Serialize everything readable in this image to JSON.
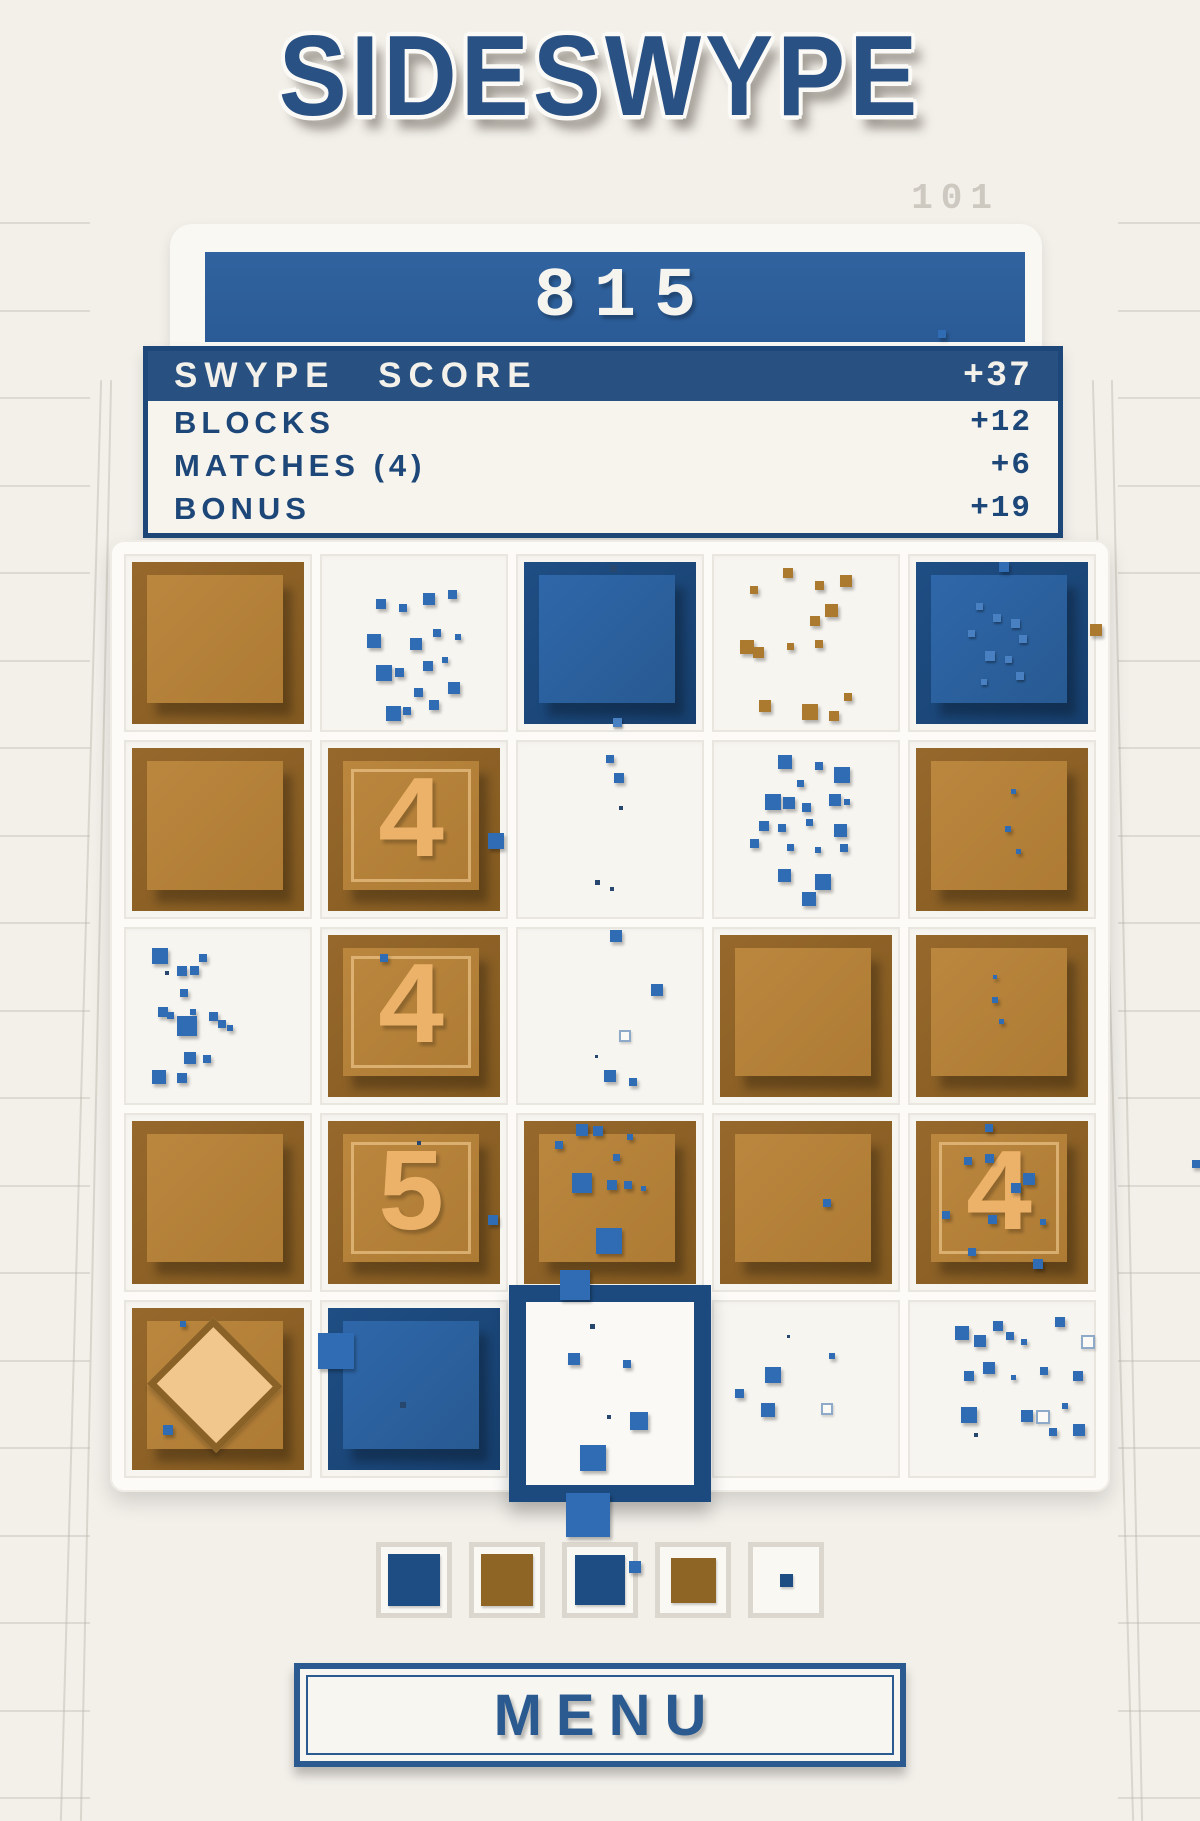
{
  "title": "SIDESWYPE",
  "hud": {
    "level": "101",
    "score": "815"
  },
  "score_panel": {
    "header_label": "SWYPE SCORE",
    "header_value": "+37",
    "rows": [
      {
        "label": "BLOCKS",
        "value": "+12"
      },
      {
        "label": "MATCHES (4)",
        "value": "+6"
      },
      {
        "label": "BONUS",
        "value": "+19"
      }
    ]
  },
  "menu_label": "MENU",
  "colors": {
    "accent_blue": "#2a5183",
    "bar_blue": "#2e5f9e",
    "block_blue": "#1d4d82",
    "block_brown": "#97682c",
    "numeral_tan": "#edb269",
    "background": "#f3f0ea"
  },
  "grid": {
    "rows": 5,
    "cols": 5,
    "cells": [
      {
        "type": "brown"
      },
      {
        "type": "empty",
        "dots": [
          [
            30,
            25,
            10,
            "b"
          ],
          [
            42,
            28,
            8,
            "b"
          ],
          [
            55,
            22,
            12,
            "b"
          ],
          [
            68,
            20,
            9,
            "b"
          ],
          [
            25,
            45,
            14,
            "b"
          ],
          [
            48,
            47,
            12,
            "b"
          ],
          [
            60,
            42,
            8,
            "b"
          ],
          [
            72,
            45,
            6,
            "b"
          ],
          [
            30,
            62,
            16,
            "b"
          ],
          [
            40,
            64,
            9,
            "b"
          ],
          [
            55,
            60,
            10,
            "b"
          ],
          [
            65,
            58,
            6,
            "b"
          ],
          [
            50,
            75,
            9,
            "b"
          ],
          [
            68,
            72,
            12,
            "b"
          ],
          [
            35,
            85,
            15,
            "b"
          ],
          [
            44,
            86,
            8,
            "b"
          ],
          [
            58,
            82,
            10,
            "b"
          ]
        ]
      },
      {
        "type": "blue",
        "dots": [
          [
            50,
            2,
            7,
            "d"
          ],
          [
            52,
            96,
            9,
            "l"
          ]
        ]
      },
      {
        "type": "empty",
        "dots": [
          [
            38,
            8,
            10,
            "n"
          ],
          [
            20,
            18,
            8,
            "n"
          ],
          [
            55,
            15,
            9,
            "n"
          ],
          [
            68,
            12,
            12,
            "n"
          ],
          [
            60,
            28,
            13,
            "n"
          ],
          [
            52,
            35,
            10,
            "n"
          ],
          [
            15,
            48,
            14,
            "n"
          ],
          [
            22,
            52,
            11,
            "n"
          ],
          [
            40,
            50,
            7,
            "n"
          ],
          [
            55,
            48,
            8,
            "n"
          ],
          [
            25,
            82,
            12,
            "n"
          ],
          [
            48,
            84,
            16,
            "n"
          ],
          [
            62,
            88,
            10,
            "n"
          ],
          [
            70,
            78,
            8,
            "n"
          ]
        ]
      },
      {
        "type": "blue",
        "dots": [
          [
            35,
            25,
            7,
            "l"
          ],
          [
            45,
            32,
            8,
            "l"
          ],
          [
            55,
            35,
            9,
            "l"
          ],
          [
            30,
            42,
            7,
            "l"
          ],
          [
            60,
            45,
            8,
            "l"
          ],
          [
            40,
            55,
            10,
            "l"
          ],
          [
            52,
            58,
            7,
            "l"
          ],
          [
            58,
            68,
            8,
            "l"
          ],
          [
            38,
            72,
            6,
            "l"
          ],
          [
            48,
            0,
            10,
            "b"
          ]
        ]
      },
      {
        "type": "brown"
      },
      {
        "type": "brown",
        "num": "4",
        "dots": [
          [
            93,
            52,
            16,
            "b"
          ]
        ]
      },
      {
        "type": "empty",
        "dots": [
          [
            48,
            8,
            8,
            "b"
          ],
          [
            52,
            18,
            10,
            "b"
          ],
          [
            55,
            37,
            4,
            "d"
          ],
          [
            42,
            78,
            5,
            "d"
          ],
          [
            50,
            82,
            4,
            "d"
          ]
        ]
      },
      {
        "type": "empty",
        "dots": [
          [
            35,
            8,
            14,
            "b"
          ],
          [
            55,
            12,
            8,
            "b"
          ],
          [
            65,
            15,
            16,
            "b"
          ],
          [
            45,
            22,
            7,
            "b"
          ],
          [
            28,
            30,
            16,
            "b"
          ],
          [
            38,
            32,
            12,
            "b"
          ],
          [
            48,
            35,
            9,
            "b"
          ],
          [
            62,
            30,
            12,
            "b"
          ],
          [
            70,
            33,
            6,
            "b"
          ],
          [
            25,
            45,
            10,
            "b"
          ],
          [
            35,
            47,
            8,
            "b"
          ],
          [
            50,
            44,
            7,
            "b"
          ],
          [
            65,
            47,
            13,
            "b"
          ],
          [
            20,
            55,
            9,
            "b"
          ],
          [
            40,
            58,
            7,
            "b"
          ],
          [
            55,
            60,
            6,
            "b"
          ],
          [
            68,
            58,
            8,
            "b"
          ],
          [
            35,
            72,
            13,
            "b"
          ],
          [
            55,
            75,
            16,
            "b"
          ],
          [
            48,
            85,
            14,
            "b"
          ]
        ]
      },
      {
        "type": "brown",
        "dots": [
          [
            55,
            25,
            5,
            "b"
          ],
          [
            52,
            48,
            6,
            "b"
          ],
          [
            58,
            62,
            5,
            "b"
          ]
        ]
      },
      {
        "type": "empty",
        "dots": [
          [
            15,
            12,
            16,
            "b"
          ],
          [
            40,
            15,
            8,
            "b"
          ],
          [
            28,
            22,
            10,
            "b"
          ],
          [
            35,
            22,
            9,
            "b"
          ],
          [
            22,
            25,
            4,
            "d"
          ],
          [
            30,
            35,
            8,
            "b"
          ],
          [
            18,
            45,
            10,
            "b"
          ],
          [
            23,
            48,
            7,
            "b"
          ],
          [
            35,
            46,
            6,
            "b"
          ],
          [
            45,
            48,
            9,
            "b"
          ],
          [
            28,
            50,
            20,
            "b"
          ],
          [
            50,
            52,
            8,
            "b"
          ],
          [
            55,
            55,
            6,
            "b"
          ],
          [
            32,
            70,
            12,
            "b"
          ],
          [
            42,
            72,
            8,
            "b"
          ],
          [
            15,
            80,
            14,
            "b"
          ],
          [
            28,
            82,
            10,
            "b"
          ]
        ]
      },
      {
        "type": "brown",
        "num": "4",
        "dots": [
          [
            30,
            12,
            8,
            "b"
          ]
        ]
      },
      {
        "type": "empty",
        "dots": [
          [
            50,
            2,
            12,
            "b"
          ],
          [
            72,
            32,
            12,
            "b"
          ],
          [
            55,
            58,
            8,
            "g"
          ],
          [
            47,
            80,
            12,
            "b"
          ],
          [
            60,
            85,
            8,
            "b"
          ],
          [
            42,
            72,
            3,
            "d"
          ]
        ]
      },
      {
        "type": "brown"
      },
      {
        "type": "brown",
        "dots": [
          [
            45,
            25,
            4,
            "b"
          ],
          [
            44,
            38,
            6,
            "b"
          ],
          [
            48,
            52,
            5,
            "b"
          ]
        ]
      },
      {
        "type": "brown"
      },
      {
        "type": "brown",
        "num": "5",
        "dots": [
          [
            52,
            12,
            4,
            "d"
          ],
          [
            93,
            58,
            10,
            "b"
          ]
        ]
      },
      {
        "type": "brown",
        "dots": [
          [
            30,
            2,
            12,
            "b"
          ],
          [
            40,
            3,
            10,
            "b"
          ],
          [
            18,
            12,
            8,
            "b"
          ],
          [
            52,
            20,
            7,
            "b"
          ],
          [
            28,
            32,
            20,
            "b"
          ],
          [
            48,
            36,
            10,
            "b"
          ],
          [
            58,
            37,
            8,
            "b"
          ],
          [
            68,
            40,
            5,
            "b"
          ],
          [
            42,
            66,
            26,
            "b"
          ],
          [
            60,
            8,
            6,
            "b"
          ]
        ]
      },
      {
        "type": "brown",
        "dots": [
          [
            60,
            48,
            8,
            "b"
          ]
        ]
      },
      {
        "type": "brown",
        "num": "4",
        "dots": [
          [
            28,
            22,
            8,
            "b"
          ],
          [
            40,
            20,
            9,
            "b"
          ],
          [
            62,
            32,
            12,
            "b"
          ],
          [
            55,
            38,
            10,
            "b"
          ],
          [
            15,
            55,
            8,
            "b"
          ],
          [
            42,
            58,
            9,
            "b"
          ],
          [
            72,
            60,
            6,
            "b"
          ],
          [
            30,
            78,
            8,
            "b"
          ],
          [
            68,
            85,
            10,
            "b"
          ],
          [
            40,
            2,
            8,
            "b"
          ]
        ]
      },
      {
        "type": "diamond",
        "dots": [
          [
            28,
            8,
            6,
            "b"
          ],
          [
            18,
            72,
            10,
            "b"
          ]
        ]
      },
      {
        "type": "blue",
        "dots": [
          [
            42,
            58,
            6,
            "d"
          ]
        ]
      },
      {
        "type": "selected",
        "dots": [
          [
            38,
            12,
            5,
            "d"
          ],
          [
            25,
            28,
            12,
            "b"
          ],
          [
            58,
            32,
            8,
            "b"
          ],
          [
            48,
            62,
            4,
            "d"
          ],
          [
            62,
            60,
            18,
            "b"
          ],
          [
            32,
            78,
            26,
            "b"
          ]
        ]
      },
      {
        "type": "empty",
        "dots": [
          [
            12,
            50,
            9,
            "b"
          ],
          [
            28,
            38,
            16,
            "b"
          ],
          [
            26,
            58,
            14,
            "b"
          ],
          [
            62,
            30,
            6,
            "b"
          ],
          [
            58,
            58,
            8,
            "g"
          ],
          [
            40,
            20,
            3,
            "d"
          ]
        ]
      },
      {
        "type": "empty",
        "dots": [
          [
            25,
            15,
            14,
            "b"
          ],
          [
            45,
            12,
            10,
            "b"
          ],
          [
            52,
            18,
            8,
            "b"
          ],
          [
            35,
            20,
            12,
            "b"
          ],
          [
            60,
            22,
            6,
            "b"
          ],
          [
            78,
            10,
            10,
            "b"
          ],
          [
            92,
            20,
            10,
            "g"
          ],
          [
            40,
            35,
            12,
            "b"
          ],
          [
            30,
            40,
            10,
            "b"
          ],
          [
            55,
            42,
            5,
            "b"
          ],
          [
            70,
            38,
            8,
            "b"
          ],
          [
            88,
            40,
            10,
            "b"
          ],
          [
            28,
            60,
            16,
            "b"
          ],
          [
            60,
            62,
            12,
            "b"
          ],
          [
            68,
            62,
            10,
            "g"
          ],
          [
            82,
            58,
            6,
            "b"
          ],
          [
            75,
            72,
            8,
            "b"
          ],
          [
            88,
            70,
            12,
            "b"
          ],
          [
            35,
            75,
            4,
            "d"
          ]
        ]
      }
    ]
  },
  "preview": [
    {
      "color": "blue",
      "size": 52
    },
    {
      "color": "brown",
      "size": 52
    },
    {
      "color": "blue",
      "size": 50,
      "edge_dot": true
    },
    {
      "color": "brown",
      "size": 45
    },
    {
      "color": "blue",
      "size": 13
    }
  ],
  "floaters": [
    {
      "x": 938,
      "y": 330,
      "s": 8,
      "c": "b"
    },
    {
      "x": 560,
      "y": 1270,
      "s": 30,
      "c": "b"
    },
    {
      "x": 566,
      "y": 1493,
      "s": 44,
      "c": "b"
    },
    {
      "x": 318,
      "y": 1333,
      "s": 36,
      "c": "b"
    },
    {
      "x": 1090,
      "y": 624,
      "s": 12,
      "c": "n"
    },
    {
      "x": 1192,
      "y": 1160,
      "s": 8,
      "c": "b"
    }
  ]
}
